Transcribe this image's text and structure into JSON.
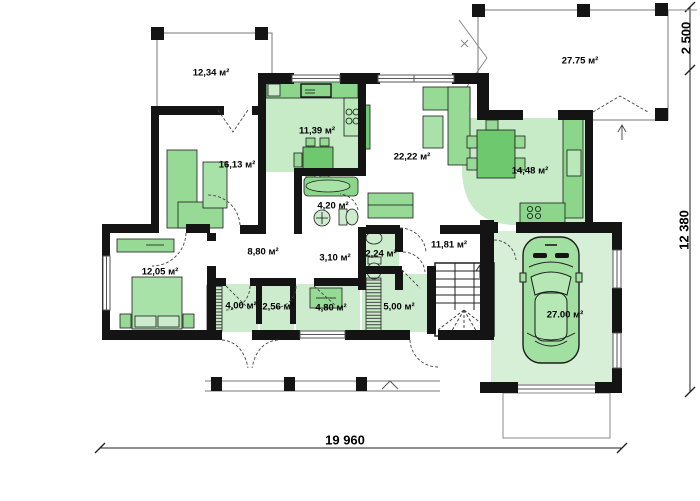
{
  "plan": {
    "type": "architectural-floor-plan",
    "rooms": [
      {
        "name": "terrace-upper-left",
        "area": "12,34 м²"
      },
      {
        "name": "terrace-upper-right",
        "area": "27.75 м²"
      },
      {
        "name": "kitchen",
        "area": "11,39 м²"
      },
      {
        "name": "room-left",
        "area": "16,13 м²"
      },
      {
        "name": "living-room",
        "area": "22,22 м²"
      },
      {
        "name": "dining",
        "area": "14,48 м²"
      },
      {
        "name": "bathroom",
        "area": "4,20 м²"
      },
      {
        "name": "hallway",
        "area": "8,80 м²"
      },
      {
        "name": "corridor",
        "area": "3,10 м²"
      },
      {
        "name": "wc",
        "area": "2,24 м²"
      },
      {
        "name": "hall-stairs",
        "area": "11,81 м²"
      },
      {
        "name": "bedroom",
        "area": "12,05 м²"
      },
      {
        "name": "vestibule",
        "area": "4,00 м²"
      },
      {
        "name": "closet",
        "area": "2,56 м²"
      },
      {
        "name": "utility",
        "area": "4,80 м²"
      },
      {
        "name": "boiler-room",
        "area": "5,00 м²"
      },
      {
        "name": "garage",
        "area": "27.00 м²"
      }
    ],
    "dimensions": {
      "overall_width": "19 960",
      "overall_depth": "12 380",
      "terrace_depth": "2 500"
    },
    "colors": {
      "wall": "#141414",
      "room_fill": "#cdeccd",
      "furniture_fill": "#96da96",
      "furniture_dark": "#6ec96e",
      "car_fill": "#a2e0a2",
      "thin_line": "#555555"
    }
  }
}
